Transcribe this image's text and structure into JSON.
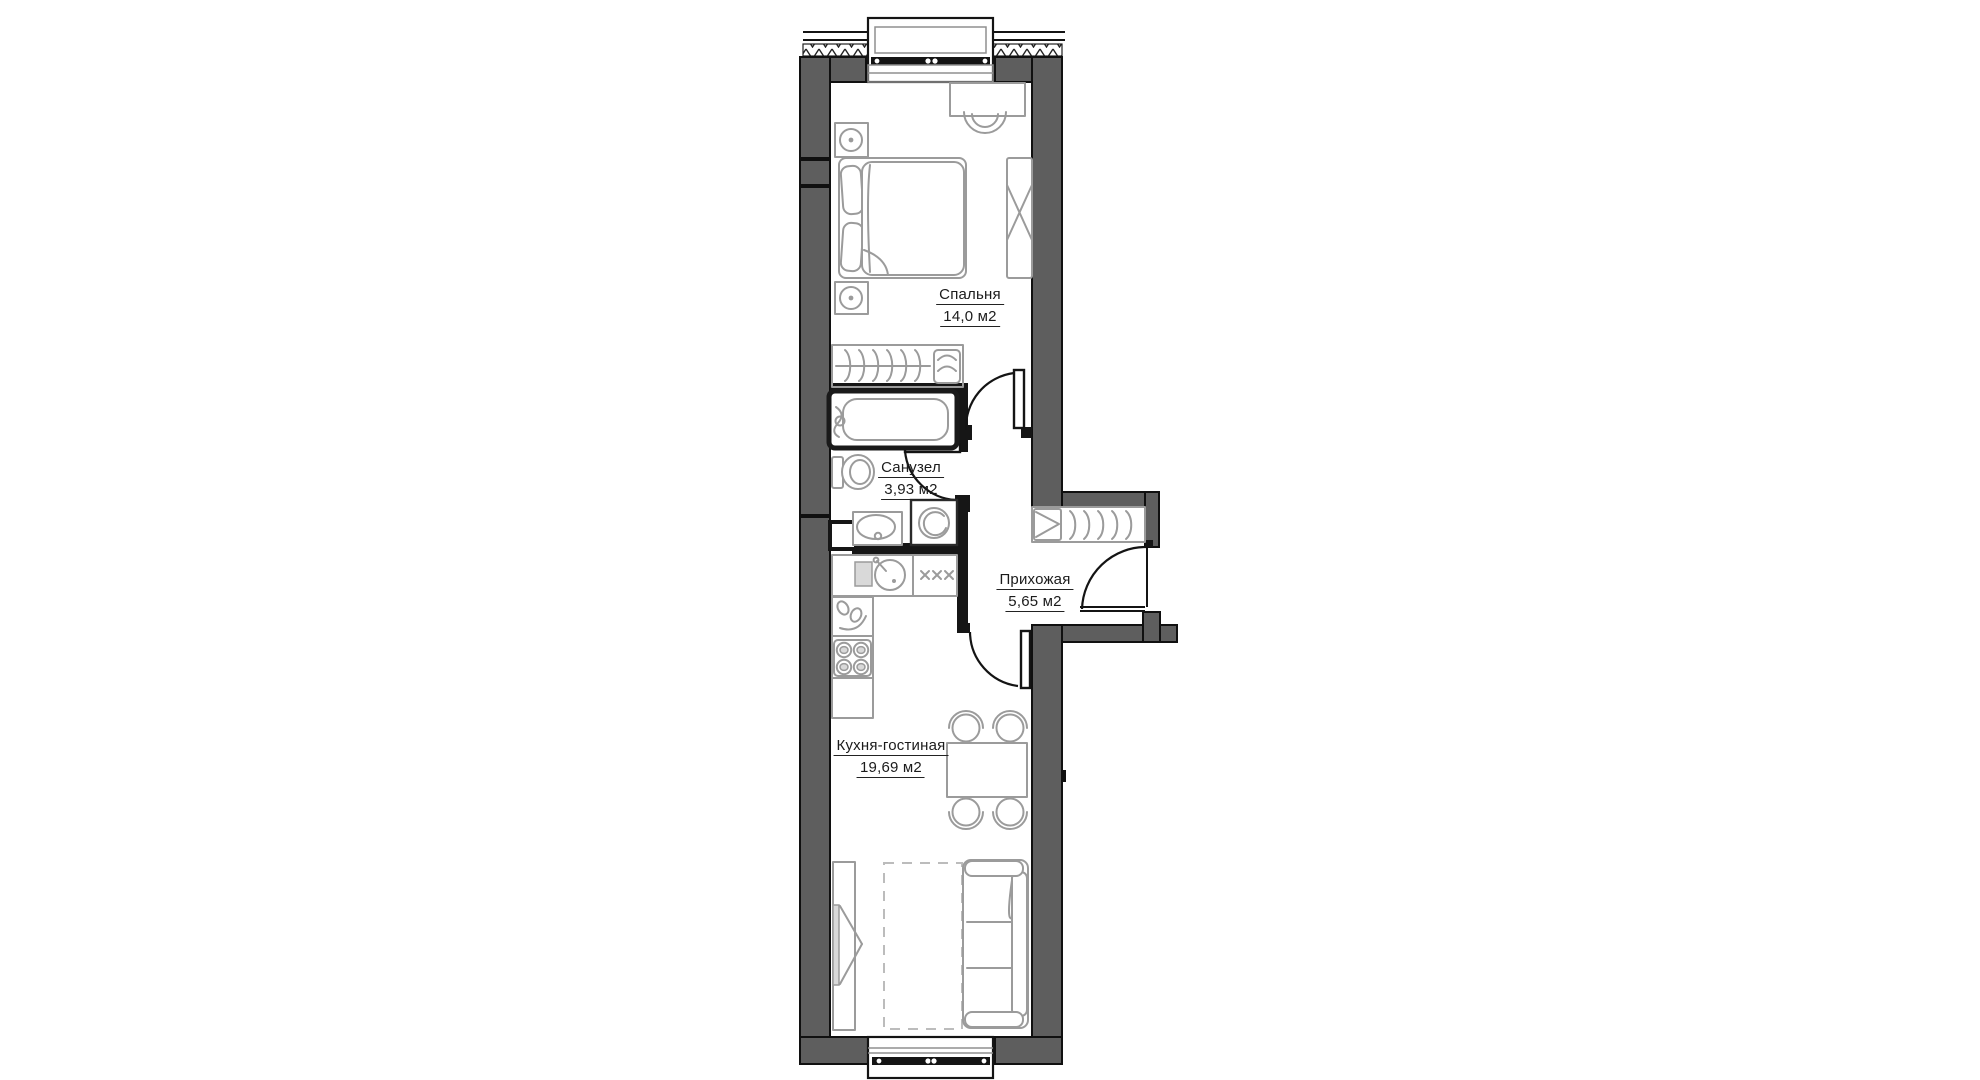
{
  "title": "Apartment floor plan",
  "colors": {
    "wall": "#5e5e5e",
    "ink": "#101010",
    "furniture": "#9b9b9b",
    "floor": "#ffffff",
    "label": "#1b1b1b"
  },
  "rooms": [
    {
      "id": "bedroom",
      "name": "Спальня",
      "area": "14,0 м2"
    },
    {
      "id": "bathroom",
      "name": "Санузел",
      "area": "3,93 м2"
    },
    {
      "id": "hallway",
      "name": "Прихожая",
      "area": "5,65 м2"
    },
    {
      "id": "kitchen_living",
      "name": "Кухня-гостиная",
      "area": "19,69 м2"
    }
  ],
  "furniture": {
    "bedroom": [
      "double-bed",
      "nightstand-2x",
      "sliding-wardrobe",
      "closet-with-hangers",
      "desk",
      "chair"
    ],
    "bathroom": [
      "bathtub",
      "toilet",
      "sink",
      "washing-machine",
      "vent-shaft"
    ],
    "hallway": [
      "shoe-cabinet",
      "closet-with-hangers",
      "entrance-door"
    ],
    "kitchen_living": [
      "kitchen-counter",
      "round-sink",
      "cooktop-4-burner",
      "appliance-unit",
      "dining-table",
      "chairs-4x",
      "sofa-3-seat",
      "rug",
      "tv-console"
    ]
  },
  "openings": [
    "balcony-door-top",
    "balcony-door-bottom",
    "bedroom-door",
    "bathroom-door",
    "kitchen-door",
    "entrance-door"
  ]
}
